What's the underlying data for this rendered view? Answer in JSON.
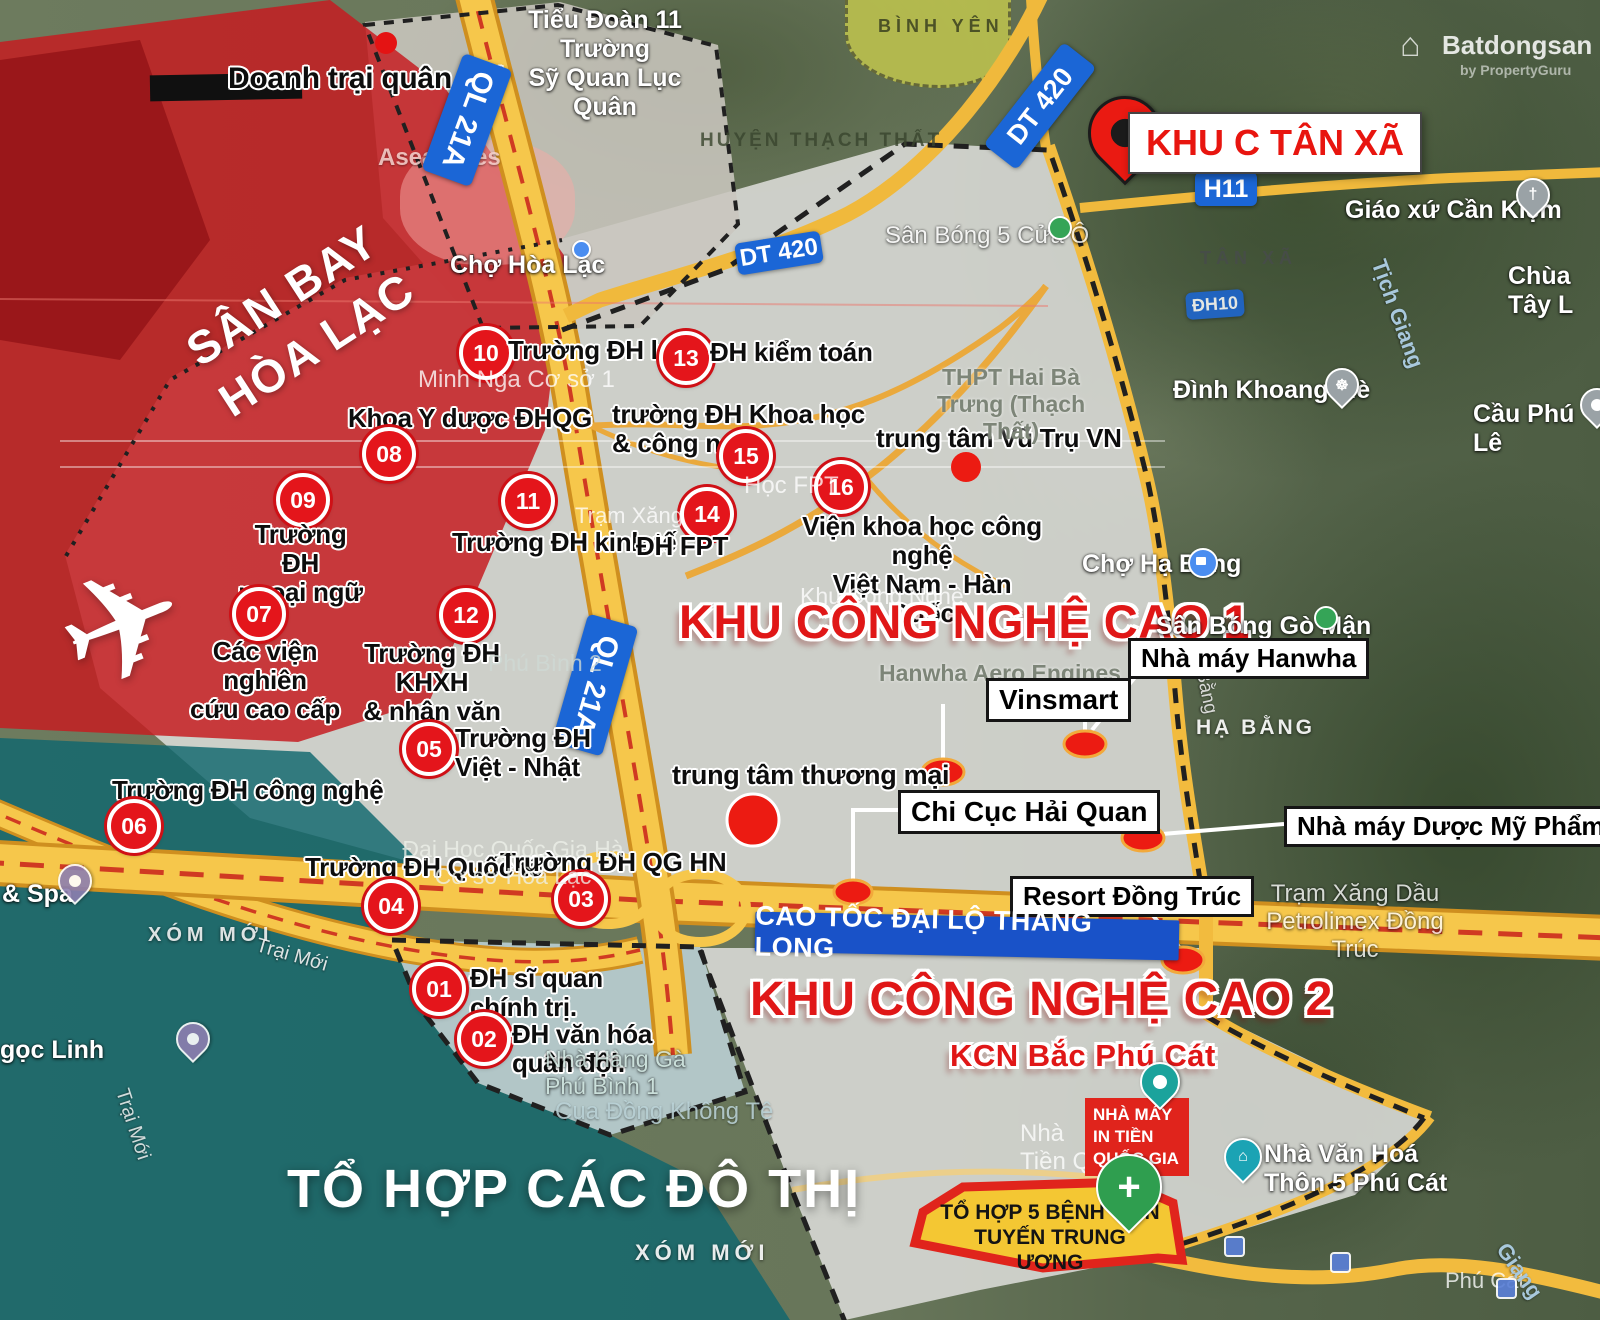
{
  "zones": {
    "airport": "SÂN BAY\nHÒA LẠC",
    "hitech1": "KHU CÔNG NGHỆ CAO 1",
    "hitech2": "KHU CÔNG NGHỆ CAO 2",
    "kcn": "KCN Bắc Phú Cát",
    "urban": "TỔ HỢP CÁC ĐÔ THỊ",
    "khuc": "KHU C TÂN XÃ",
    "military_camp": "Doanh trại quân đội"
  },
  "roads": {
    "ql21a": "QL 21A",
    "dt420": "DT 420",
    "h11": "H11",
    "dh10": "ĐH10",
    "thanglong": "CAO TỐC ĐẠI LỘ THĂNG LONG"
  },
  "universities": [
    {
      "num": "01",
      "label": "ĐH sĩ quan\nchính trị."
    },
    {
      "num": "02",
      "label": "ĐH văn hóa\nquân đội."
    },
    {
      "num": "03",
      "label": "Trường ĐH QG HN"
    },
    {
      "num": "04",
      "label": "Trường ĐH Quốc tế"
    },
    {
      "num": "05",
      "label": "Trường ĐH\nViệt - Nhật"
    },
    {
      "num": "06",
      "label": "Trường ĐH công nghệ"
    },
    {
      "num": "07",
      "label": "Các viện nghiên\ncứu cao cấp"
    },
    {
      "num": "08",
      "label": "Khoa Y dược ĐHQG"
    },
    {
      "num": "09",
      "label": "Trường ĐH\nngoại ngữ"
    },
    {
      "num": "10",
      "label": "Trường ĐH luật"
    },
    {
      "num": "11",
      "label": "Trường ĐH kinh tế"
    },
    {
      "num": "12",
      "label": "Trường ĐH KHXH\n& nhân văn"
    },
    {
      "num": "13",
      "label": "ĐH kiểm toán"
    },
    {
      "num": "14",
      "label": "ĐH FPT"
    },
    {
      "num": "15",
      "label": "trường ĐH Khoa học\n& công nghệ"
    },
    {
      "num": "16",
      "label": "Viện khoa học công nghệ\nViệt Nam - Hàn Quốc"
    }
  ],
  "facilities": {
    "space": "trung tâm Vũ Trụ VN",
    "mall": "trung tâm thương mại",
    "vinsmart": "Vinsmart",
    "hanwha": "Nhà máy Hanwha",
    "customs": "Chi Cục Hải Quan",
    "pharma": "Nhà máy Dược Mỹ Phẩm C",
    "resort": "Resort  Đồng Trúc",
    "mint": "NHÀ MÁY\nIN TIỀN\nQUỐC GIA",
    "hospital": "TỔ HỢP 5 BỆNH VIỆN\nTUYẾN TRUNG ƯƠNG"
  },
  "map_labels": {
    "tieudoan": "Tiểu Đoàn 11 Trường\nSỹ Quan Lục Quân",
    "asean": "Asean Res",
    "binhyen": "BÌNH YÊN",
    "chohoalac": "Chợ Hòa Lạc",
    "huyen": "HUYỆN THẠCH THẤT",
    "sanbong5": "Sân Bóng 5 Cửa Ô",
    "tanxa": "TÂN XÃ",
    "giaoxu": "Giáo xứ Cần Kiệm",
    "chuatay": "Chùa Tây L",
    "dinhkhoang": "Đình Khoang Mè",
    "cauphule": "Cầu Phú Lê",
    "tichgiang": "Tịch Giang",
    "minhnga": "Minh Nga Cơ sở 1",
    "thpt": "THPT Hai Bà\nTrưng (Thạch Thất)",
    "hocfpt": "Học FPT",
    "tramxang": "Trạm Xăng",
    "khucn": "Khu Công Nghệ",
    "hanwha_bg": "Hanwha Aero Engines",
    "chohabang": "Chợ Hạ Bằng",
    "sanbonggoman": "Sân Bóng Gò Mận",
    "habang": "HẠ BẰNG",
    "bang": "Bằng",
    "phubinh2": "Phú Bình 2",
    "daihocqg": "Đại Học Quốc Gia Hà\nCơ sở Hòa Lạc",
    "petrolimex": "Trạm Xăng Dầu\nPetrolimex Đồng Trúc",
    "nhavanhoa": "Nhà Văn Hoá\nThôn 5 Phú Cát",
    "phucat": "Phú Cát",
    "nhatienq": "Nhà\nTiền Q",
    "nhahangga": "Nhà Hàng Gà\nPhú Bình 1",
    "cuadong": "Cua Đồng Không Tê",
    "xommoi": "XÓM MỚI",
    "ngoclinh": "gọc Linh",
    "spa": "& Spa",
    "traimoi": "Trại Mới",
    "giang": "Giang"
  },
  "watermark": {
    "brand": "Batdongsan",
    "sub": "by PropertyGuru"
  },
  "icons": {
    "airplane": "✈",
    "cross": "+",
    "church": "†",
    "wheel": "☸",
    "house": "⌂"
  },
  "colors": {
    "accent_red": "#e01717",
    "road_yellow": "#f6c74b",
    "badge_blue": "#1b66d6",
    "zone_teal": "#10676e",
    "marker_red": "#e4151b",
    "hospital_green": "#2f9e4f"
  }
}
